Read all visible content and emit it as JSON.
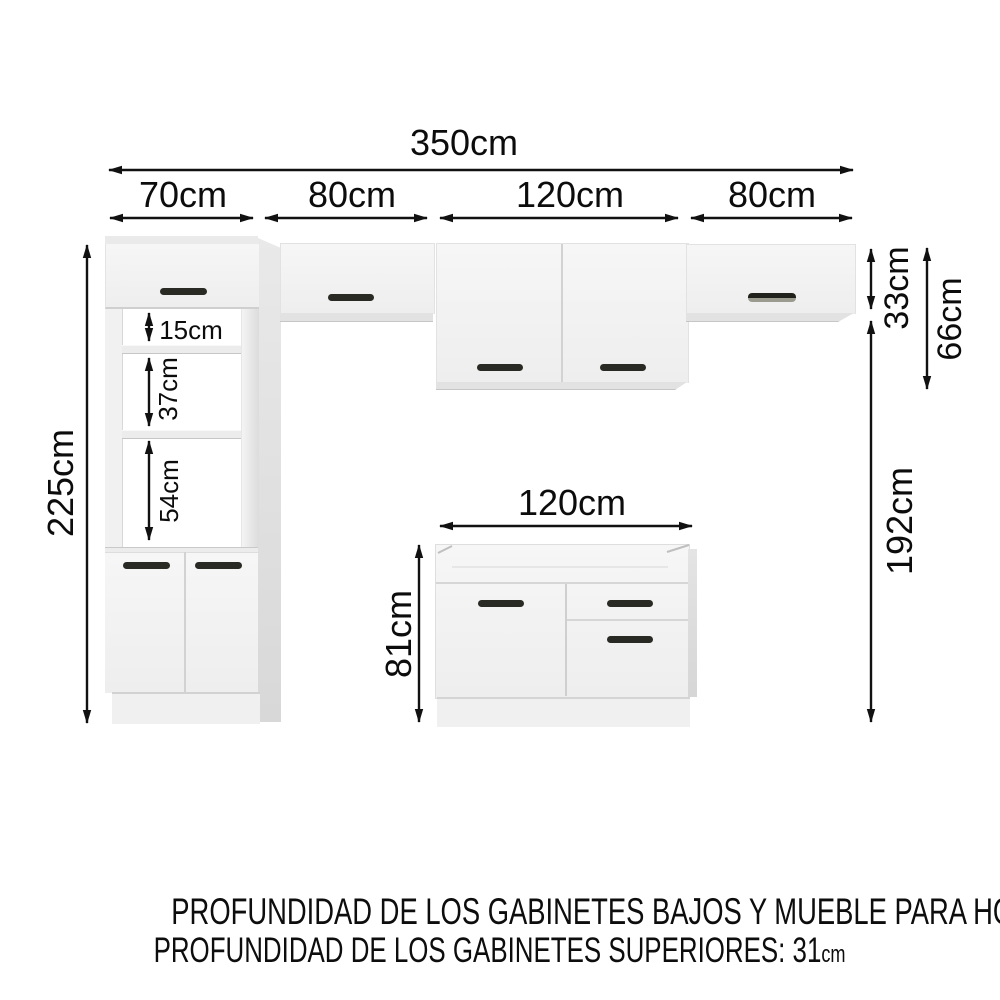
{
  "diagram": {
    "total_width": "350cm",
    "sections": [
      "70cm",
      "80cm",
      "120cm",
      "80cm"
    ],
    "tall_cabinet_height": "225cm",
    "tower_openings": [
      "15cm",
      "37cm",
      "54cm"
    ],
    "upper_small_height": "33cm",
    "upper_large_height": "66cm",
    "below_uppers_span": "192cm",
    "base_width": "120cm",
    "base_height": "81cm"
  },
  "footer": {
    "line1_label": "PROFUNDIDAD DE LOS GABINETES BAJOS Y MUEBLE PARA HORNO: 52",
    "line1_unit": "cm",
    "line2_label": "PROFUNDIDAD DE LOS GABINETES SUPERIORES: 31",
    "line2_unit": "cm"
  },
  "colors": {
    "background": "#ffffff",
    "cabinet_face": "#f3f3f3",
    "cabinet_side": "#dedede",
    "cabinet_interior": "#ffffff",
    "handle": "#2a2a24",
    "dimension_ink": "#111111"
  }
}
